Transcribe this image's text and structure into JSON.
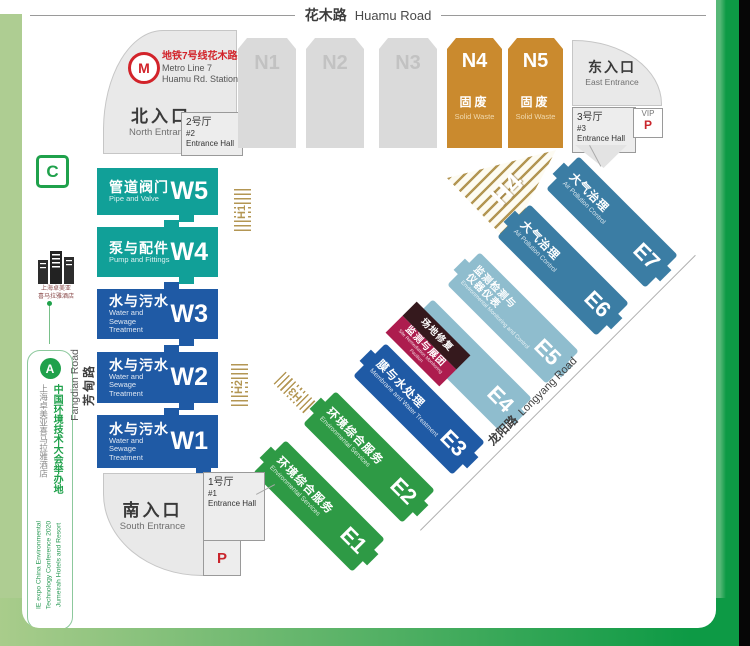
{
  "roads": {
    "top_zh": "花木路",
    "top_en": "Huamu Road",
    "left_zh": "芳甸路",
    "left_en": "Fangdian Road",
    "diag_zh": "龙阳路",
    "diag_en": "Longyang Road"
  },
  "metro": {
    "logo_letter": "M",
    "zh": "地铁7号线花木路站",
    "en_line1": "Metro Line 7",
    "en_line2": "Huamu Rd. Station"
  },
  "entrances": {
    "north": {
      "zh": "北入口",
      "en": "North Entrance"
    },
    "east": {
      "zh": "东入口",
      "en": "East Entrance"
    },
    "south": {
      "zh": "南入口",
      "en": "South Entrance"
    }
  },
  "entrance_halls": {
    "no1": {
      "zh": "1号厅",
      "num": "#1",
      "en": "Entrance Hall"
    },
    "no2": {
      "zh": "2号厅",
      "num": "#2",
      "en": "Entrance Hall"
    },
    "no3": {
      "zh": "3号厅",
      "num": "#3",
      "en": "Entrance Hall"
    }
  },
  "parking": {
    "vip_label": "VIP",
    "p_label": "P"
  },
  "n_halls": [
    {
      "code": "N1"
    },
    {
      "code": "N2"
    },
    {
      "code": "N3"
    },
    {
      "code": "N4",
      "zh": "固废",
      "en": "Solid Waste"
    },
    {
      "code": "N5",
      "zh": "固废",
      "en": "Solid Waste"
    }
  ],
  "w_halls": [
    {
      "code": "W5",
      "zh": "管道阀门",
      "en": "Pipe and Valve"
    },
    {
      "code": "W4",
      "zh": "泵与配件",
      "en": "Pump and Fittings"
    },
    {
      "code": "W3",
      "zh": "水与污水",
      "en": "Water and Sewage Treatment"
    },
    {
      "code": "W2",
      "zh": "水与污水",
      "en": "Water and Sewage Treatment"
    },
    {
      "code": "W1",
      "zh": "水与污水",
      "en": "Water and Sewage Treatment"
    }
  ],
  "e_halls": [
    {
      "code": "E7",
      "zh1": "大气治理",
      "zh2": "",
      "en": "Air Pollution Control"
    },
    {
      "code": "E6",
      "zh1": "大气治理",
      "zh2": "",
      "en": "Air Pollution Control"
    },
    {
      "code": "E5",
      "zh1": "监测检测与",
      "zh2": "仪器仪表",
      "en": "Environmental Monitoring and Control"
    },
    {
      "code": "E4",
      "zh1": "",
      "zh2": "",
      "en": ""
    },
    {
      "code": "E3",
      "zh1": "膜与水处理",
      "zh2": "",
      "en": "Membrane and Water Treatment"
    },
    {
      "code": "E2",
      "zh1": "环境综合服务",
      "zh2": "",
      "en": "Environmental Services"
    },
    {
      "code": "E1",
      "zh1": "环境综合服务",
      "zh2": "",
      "en": "Environmental Services"
    }
  ],
  "e4_badge": {
    "zh_top": "场地修复",
    "zh_bottom": "监测与展团",
    "en": "Site Remediation Monitoring Pavilion"
  },
  "h_markers": {
    "h1": "H1",
    "h2": "H2",
    "h3": "H3",
    "h4": "H4"
  },
  "sidebar": {
    "c_logo": "C",
    "hotel_name_line1": "上海卓美亚",
    "hotel_name_line2": "喜马拉雅酒店",
    "a_logo": "A",
    "venue_zh_main": "中国环境技术大会举办地",
    "venue_zh_sub": "上海卓美亚喜马拉雅酒店",
    "venue_en_line1": "IE expo China Environmental",
    "venue_en_line2": "Technology Conference 2020",
    "venue_en_line3": "Jumeirah Hotels and Resort"
  },
  "colors": {
    "teal": "#11a098",
    "blue": "#1f5aa5",
    "steel": "#3b7da4",
    "light_blue": "#8fbdce",
    "green": "#2e9a45",
    "gold": "#ca8a2e",
    "hatch_gold": "#b39653",
    "red": "#c9252c",
    "frame_green": "#0d9a45",
    "frame_light_green": "#aecd92"
  }
}
